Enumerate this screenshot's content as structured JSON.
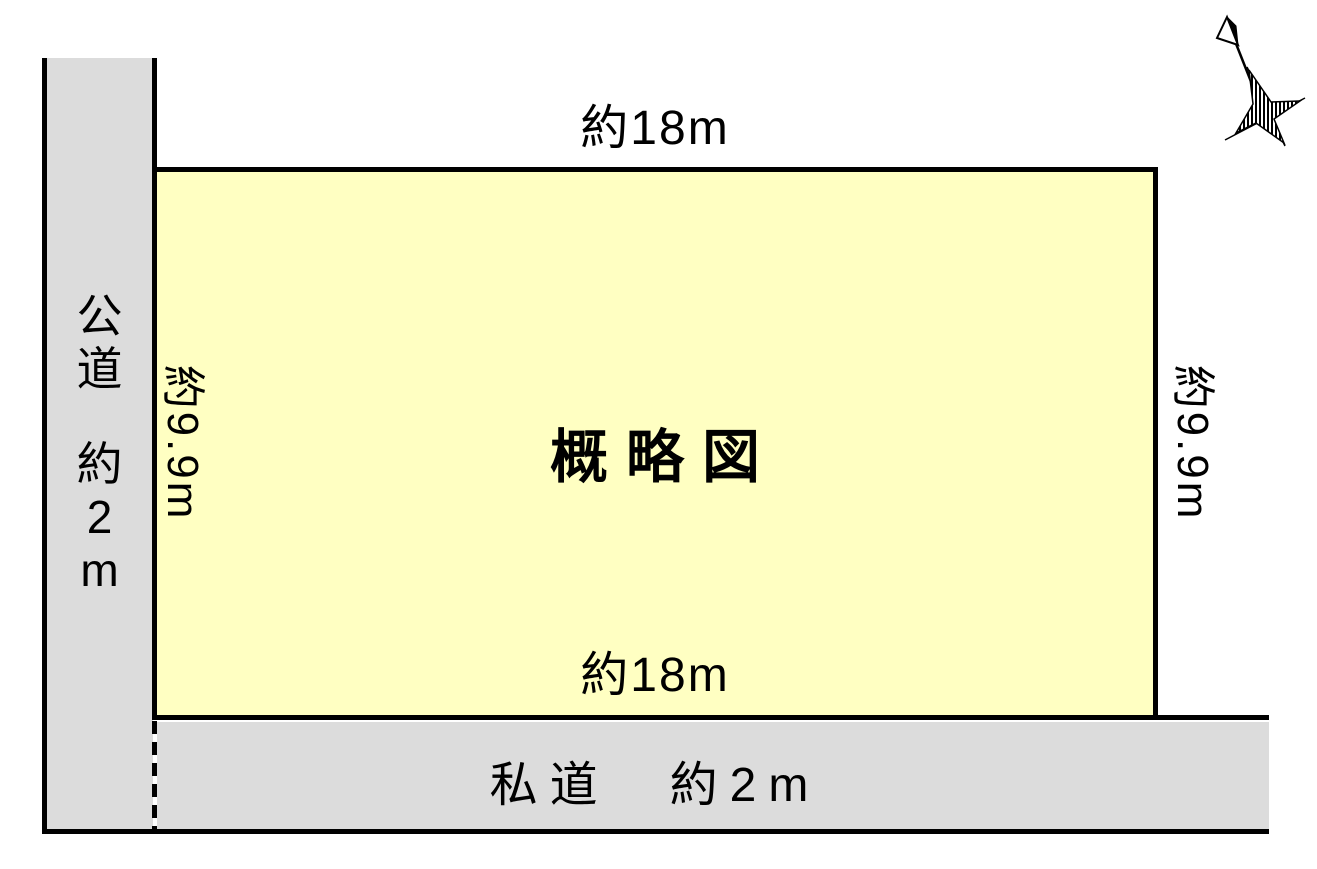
{
  "plot": {
    "title": "概略図",
    "top_dimension": "約18m",
    "bottom_dimension": "約18m",
    "left_dimension": "約9.9m",
    "right_dimension": "約9.9m"
  },
  "roads": {
    "public": {
      "label": "公道 約2m",
      "chars": [
        "公",
        "道",
        "約",
        "2",
        "m"
      ]
    },
    "private": {
      "label": "私道　約2m"
    }
  },
  "compass": {
    "meaning": "north-arrow"
  },
  "colors": {
    "plot_fill": "#ffffc2",
    "road_fill": "#dcdcdc",
    "line": "#000000",
    "background": "#ffffff"
  }
}
